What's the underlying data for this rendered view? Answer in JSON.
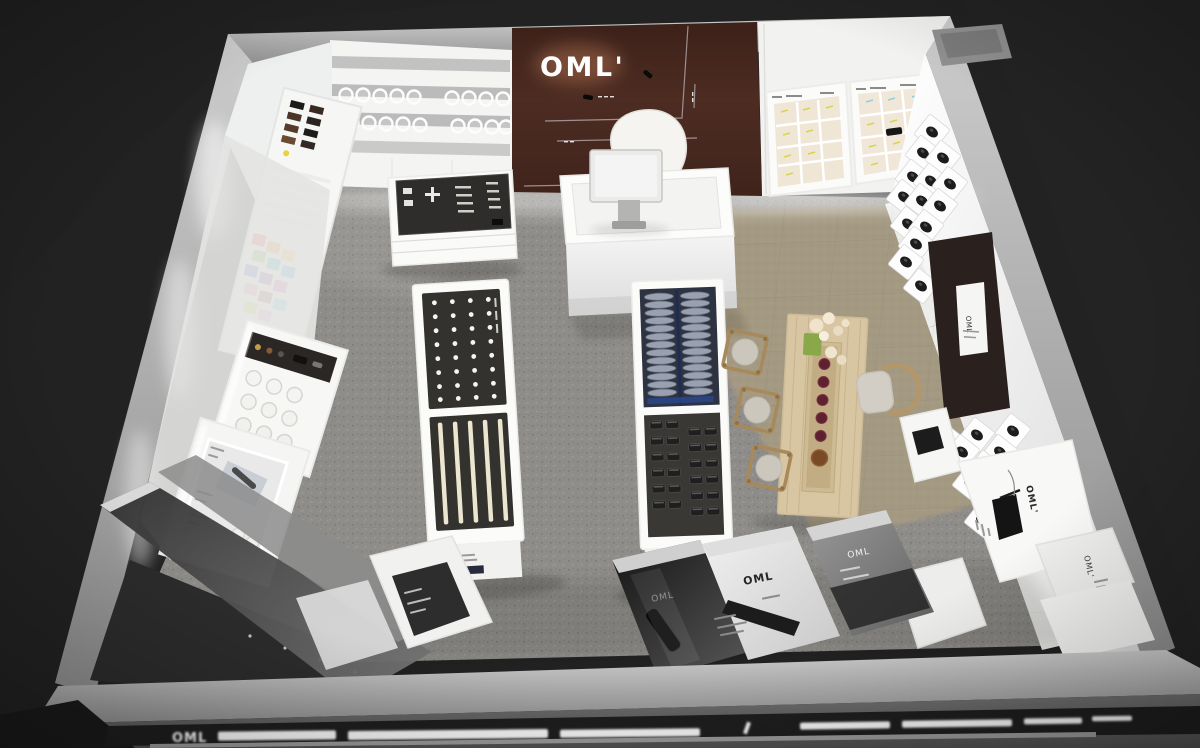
{
  "brand": {
    "logo": "OML'",
    "logo_short": "OML"
  },
  "back_wall": {
    "logo_text": "OML'",
    "panel_color": "#46281f",
    "track_light_count": 3
  },
  "storefront": {
    "sign_text": "OML",
    "sign_bar_color": "#1e1e1e"
  },
  "right_wall": {
    "cube_shelf_count": 25,
    "poster_card_text": "OML"
  },
  "bottom_right_panels": {
    "panel_a_text": "OML'",
    "panel_b_text": "OML'"
  },
  "poster_boards": {
    "board_dark_text": "OML",
    "board_light_text": "OML",
    "board_gray_text": "OML"
  },
  "fixtures": {
    "circle_shelf_row1": 9,
    "circle_shelf_row2": 9,
    "color_swatch_count": 14,
    "lens_table_dot_cols": 4,
    "lens_table_dot_rows": 8,
    "lens_table_stripes": 5,
    "disc_columns": 2,
    "discs_per_column": 13,
    "case_box_count": 24,
    "stools": 3,
    "armchairs": 1,
    "tea_cups": 5
  },
  "colors": {
    "background": "#262626",
    "carpet": "#8f8d89",
    "rug": "#a69a82",
    "wood": "#d8c6a2",
    "wall_white": "#f4f4f2",
    "accent_brown": "#46281f"
  }
}
